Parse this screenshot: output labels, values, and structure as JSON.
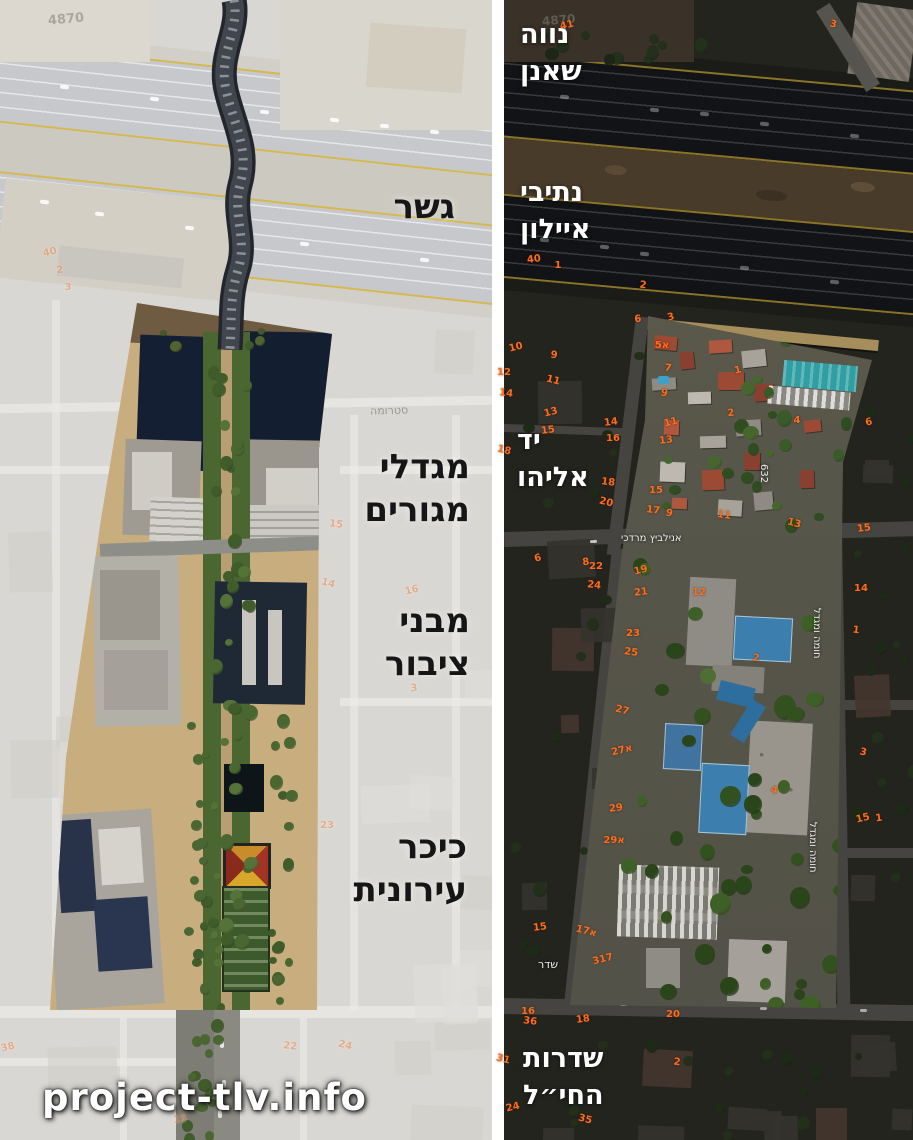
{
  "colors": {
    "annotation_black": "#161616",
    "annotation_white": "#ffffff",
    "house_number_orange": "#ff6c1c",
    "court_blue": "#3c7fae",
    "roof_red": "#9c4a33",
    "canopy_teal": "#2f9fa4",
    "highlight_green": "#4a6631",
    "plaza_tan": "#c8ad7f"
  },
  "watermark": "project-tlv.info",
  "left_panel": {
    "grid_ref": "4870",
    "annotations": {
      "bridge": "גשר",
      "towers_line1": "מגדלי",
      "towers_line2": "מגורים",
      "public_line1": "מבני",
      "public_line2": "ציבור",
      "square_line1": "כיכר",
      "square_line2": "עירונית"
    },
    "street_labels": {
      "struma": "סטרומה"
    },
    "house_numbers": [
      {
        "t": "40",
        "x": 50,
        "y": 253
      },
      {
        "t": "2",
        "x": 60,
        "y": 271
      },
      {
        "t": "3",
        "x": 68,
        "y": 288
      },
      {
        "t": "15",
        "x": 336,
        "y": 525
      },
      {
        "t": "14",
        "x": 328,
        "y": 584
      },
      {
        "t": "16",
        "x": 412,
        "y": 591
      },
      {
        "t": "3",
        "x": 414,
        "y": 689
      },
      {
        "t": "23",
        "x": 327,
        "y": 826
      },
      {
        "t": "22",
        "x": 290,
        "y": 1047
      },
      {
        "t": "24",
        "x": 345,
        "y": 1046
      },
      {
        "t": "38",
        "x": 8,
        "y": 1048
      },
      {
        "t": "15",
        "x": 180,
        "y": 1120
      }
    ]
  },
  "right_panel": {
    "grid_ref": "4870",
    "annotations": {
      "neve_line1": "נווה",
      "neve_line2": "שאנן",
      "ayalon_line1": "נתיבי",
      "ayalon_line2": "איילון",
      "yad_line1": "יד",
      "yad_line2": "אליהו",
      "hahayil_line1": "שדרות",
      "hahayil_line2": "החי״ל"
    },
    "street_labels": {
      "anielewicz": "אנילביץ מרדכי",
      "homa_umigdal": "חומה ומגדל",
      "block_632": "632",
      "sderot_partial": "שדר"
    },
    "house_numbers": [
      {
        "t": "41",
        "x": 567,
        "y": 26
      },
      {
        "t": "40",
        "x": 534,
        "y": 260
      },
      {
        "t": "1",
        "x": 558,
        "y": 266
      },
      {
        "t": "2",
        "x": 643,
        "y": 286
      },
      {
        "t": "3",
        "x": 833,
        "y": 25
      },
      {
        "t": "3",
        "x": 671,
        "y": 318
      },
      {
        "t": "6",
        "x": 638,
        "y": 320
      },
      {
        "t": "5א",
        "x": 662,
        "y": 346
      },
      {
        "t": "7",
        "x": 668,
        "y": 369
      },
      {
        "t": "9",
        "x": 664,
        "y": 394
      },
      {
        "t": "11",
        "x": 671,
        "y": 423
      },
      {
        "t": "13",
        "x": 666,
        "y": 441
      },
      {
        "t": "15",
        "x": 656,
        "y": 491
      },
      {
        "t": "17",
        "x": 653,
        "y": 511
      },
      {
        "t": "9",
        "x": 669,
        "y": 514
      },
      {
        "t": "1",
        "x": 738,
        "y": 371
      },
      {
        "t": "2",
        "x": 731,
        "y": 414
      },
      {
        "t": "4",
        "x": 797,
        "y": 421
      },
      {
        "t": "11",
        "x": 724,
        "y": 516
      },
      {
        "t": "13",
        "x": 794,
        "y": 524
      },
      {
        "t": "6",
        "x": 869,
        "y": 423
      },
      {
        "t": "15",
        "x": 864,
        "y": 529
      },
      {
        "t": "14",
        "x": 861,
        "y": 589
      },
      {
        "t": "1",
        "x": 856,
        "y": 631
      },
      {
        "t": "3",
        "x": 863,
        "y": 753
      },
      {
        "t": "15",
        "x": 863,
        "y": 819
      },
      {
        "t": "1",
        "x": 879,
        "y": 819
      },
      {
        "t": "12",
        "x": 699,
        "y": 593
      },
      {
        "t": "2",
        "x": 756,
        "y": 659
      },
      {
        "t": "4",
        "x": 774,
        "y": 791
      },
      {
        "t": "19",
        "x": 641,
        "y": 571
      },
      {
        "t": "21",
        "x": 641,
        "y": 593
      },
      {
        "t": "23",
        "x": 633,
        "y": 634
      },
      {
        "t": "25",
        "x": 631,
        "y": 653
      },
      {
        "t": "27",
        "x": 622,
        "y": 711
      },
      {
        "t": "27א",
        "x": 622,
        "y": 751
      },
      {
        "t": "29",
        "x": 616,
        "y": 809
      },
      {
        "t": "29א",
        "x": 614,
        "y": 841
      },
      {
        "t": "9",
        "x": 554,
        "y": 356
      },
      {
        "t": "11",
        "x": 553,
        "y": 381
      },
      {
        "t": "13",
        "x": 551,
        "y": 413
      },
      {
        "t": "15",
        "x": 548,
        "y": 431
      },
      {
        "t": "12",
        "x": 504,
        "y": 373
      },
      {
        "t": "14",
        "x": 506,
        "y": 394
      },
      {
        "t": "18",
        "x": 504,
        "y": 451
      },
      {
        "t": "10",
        "x": 516,
        "y": 348
      },
      {
        "t": "14",
        "x": 611,
        "y": 423
      },
      {
        "t": "16",
        "x": 613,
        "y": 439
      },
      {
        "t": "18",
        "x": 608,
        "y": 483
      },
      {
        "t": "20",
        "x": 606,
        "y": 503
      },
      {
        "t": "6",
        "x": 538,
        "y": 559
      },
      {
        "t": "8",
        "x": 586,
        "y": 563
      },
      {
        "t": "22",
        "x": 596,
        "y": 567
      },
      {
        "t": "24",
        "x": 594,
        "y": 586
      },
      {
        "t": "17א",
        "x": 586,
        "y": 932
      },
      {
        "t": "317",
        "x": 603,
        "y": 960
      },
      {
        "t": "15",
        "x": 540,
        "y": 928
      },
      {
        "t": "16",
        "x": 528,
        "y": 1012
      },
      {
        "t": "36",
        "x": 530,
        "y": 1022
      },
      {
        "t": "31",
        "x": 503,
        "y": 1060
      },
      {
        "t": "24",
        "x": 513,
        "y": 1108
      },
      {
        "t": "18",
        "x": 583,
        "y": 1020
      },
      {
        "t": "20",
        "x": 673,
        "y": 1015
      },
      {
        "t": "2",
        "x": 677,
        "y": 1063
      },
      {
        "t": "35",
        "x": 585,
        "y": 1120
      }
    ]
  }
}
